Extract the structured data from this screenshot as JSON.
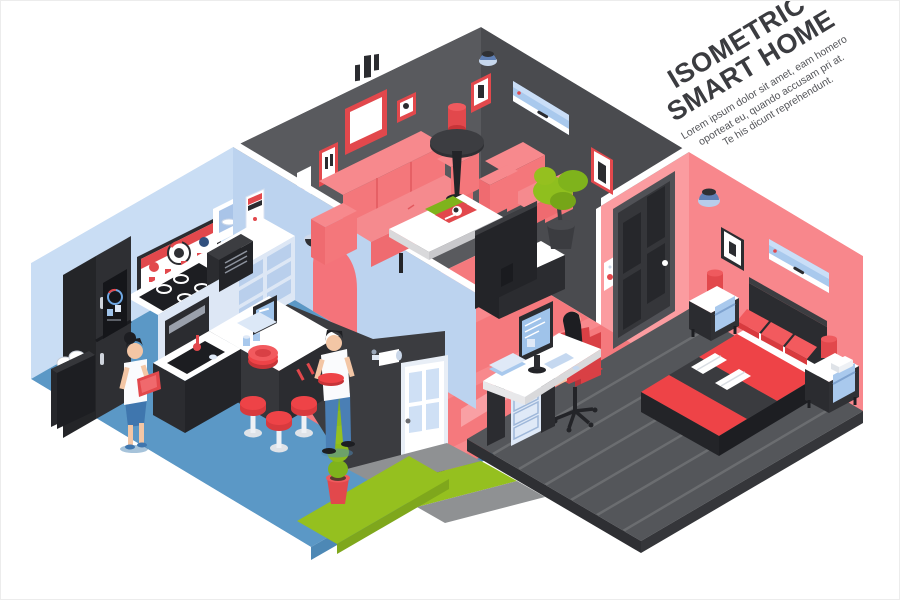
{
  "header": {
    "title_line1": "ISOMETRIC",
    "title_line2": "SMART HOME",
    "body_line1": "Lorem ipsum dolor sit amet, eam homero",
    "body_line2": "oporteat eu, quando accusam pri at.",
    "body_line3": "Te his dicunt reprehendunt."
  },
  "palette": {
    "ink": "#3b3c40",
    "wall_blue": "#c9ddf4",
    "wall_blue_divider": "#bcd3ef",
    "wall_dark_left": "#595a5e",
    "wall_dark_right": "#4a4b4f",
    "wall_pink": "#f8878c",
    "wall_pink_light": "#fb9ca0",
    "wall_exterior": "#3b3c40",
    "floor_blue": "#5b98c6",
    "floor_coral": "#f5797d",
    "floor_coral_stripe": "#f8898d",
    "floor_plank": "#54565a",
    "plank_line": "#6b6d70",
    "grass_green": "#95c01f",
    "path_gray": "#8f9193",
    "accent_red": "#ee4347",
    "frame_red": "#e2484c",
    "sofa_red": "#f4777b",
    "furniture_black": "#2b2c30",
    "ac_blue": "#a9c9ed",
    "screen_blue": "#9fc3ea",
    "skin": "#f3c6a5",
    "denim_blue": "#4a7fb5",
    "white": "#ffffff"
  }
}
